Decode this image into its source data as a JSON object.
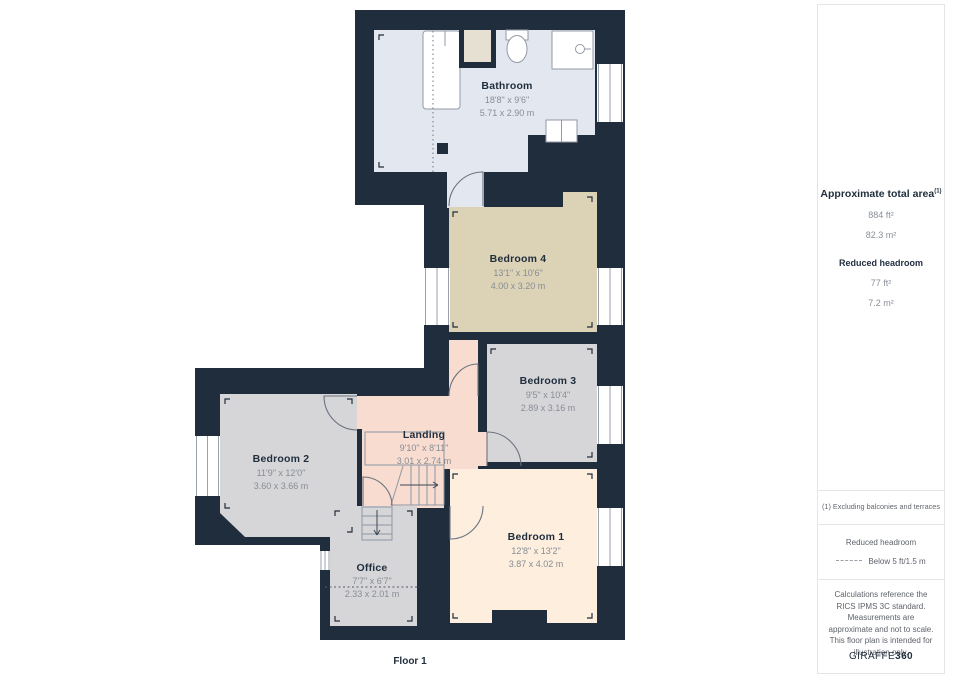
{
  "plan": {
    "floor_label": "Floor 1",
    "rooms": [
      {
        "name": "Bathroom",
        "imperial": "18'8\" x 9'6\"",
        "metric": "5.71 x 2.90 m"
      },
      {
        "name": "Bedroom 4",
        "imperial": "13'1\" x 10'6\"",
        "metric": "4.00 x 3.20 m"
      },
      {
        "name": "Bedroom 3",
        "imperial": "9'5\" x 10'4\"",
        "metric": "2.89 x 3.16 m"
      },
      {
        "name": "Bedroom 2",
        "imperial": "11'9\" x 12'0\"",
        "metric": "3.60 x 3.66 m"
      },
      {
        "name": "Landing",
        "imperial": "9'10\" x 8'11\"",
        "metric": "3.01 x 2.74 m"
      },
      {
        "name": "Bedroom 1",
        "imperial": "12'8\" x 13'2\"",
        "metric": "3.87 x 4.02 m"
      },
      {
        "name": "Office",
        "imperial": "7'7\" x 6'7\"",
        "metric": "2.33 x 2.01 m"
      }
    ]
  },
  "sidebar": {
    "total_area_label": "Approximate total area",
    "total_area_superscript": "(1)",
    "total_area_ft": "884 ft²",
    "total_area_m": "82.3 m²",
    "reduced_headroom_label": "Reduced headroom",
    "reduced_headroom_ft": "77 ft²",
    "reduced_headroom_m": "7.2 m²",
    "footnote": "(1) Excluding balconies and terraces",
    "legend_title": "Reduced headroom",
    "legend_value": "Below 5 ft/1.5 m",
    "disclaimer": "Calculations reference the RICS IPMS 3C standard. Measurements are approximate and not to scale. This floor plan is intended for illustration only.",
    "logo_left": "GIRAFFE",
    "logo_right": "360"
  },
  "colors": {
    "wall": "#1f2d3d",
    "bathroom_fill": "#e3e8f0",
    "bedroom4_fill": "#dcd2b5",
    "gray_room_fill": "#d6d6d8",
    "landing_fill": "#f8dcd0",
    "bedroom1_fill": "#fdeedd",
    "alcove_fill": "#e5e0d2",
    "dim_text": "#878d96",
    "dark_text": "#1f2d3d"
  }
}
